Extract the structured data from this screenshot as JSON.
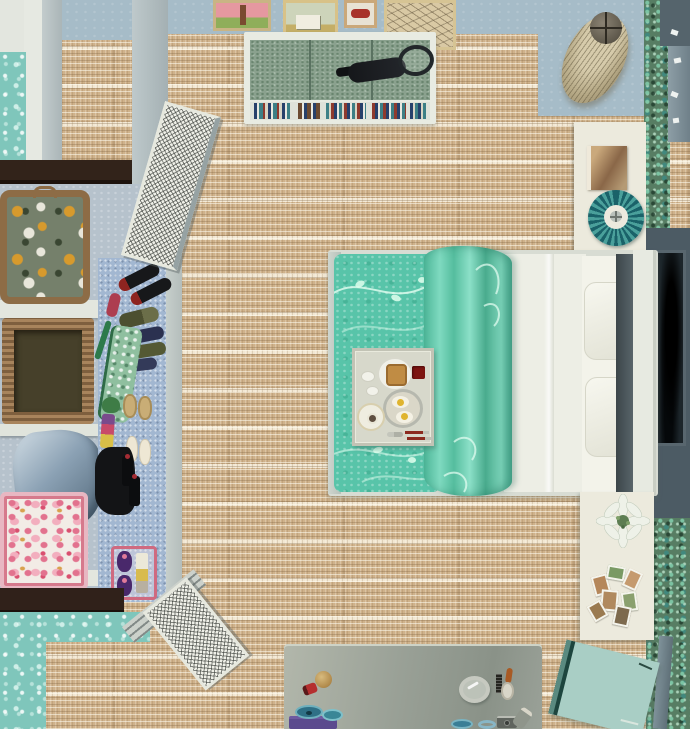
{
  "scene": {
    "view": "overhead dollhouse view",
    "room": "teal bedroom with open closet, bed with breakfast tray, bookcase and vanity desk"
  },
  "palette": {
    "floor_base": "#cfb28b",
    "floor_light": "#f0e6d0",
    "floor_dark": "#a5896a",
    "wall_blue": "#a6bcc8",
    "wall_teal_damask": "#7fc6bb",
    "wall_teal_mottled": "#577d63",
    "wall_dark_slate": "#4c5b64",
    "beam_brown": "#32231a",
    "bed_teal": "#58c4a9",
    "blanket_teal_light": "#7fdac0",
    "linen_white": "#edeee5",
    "bookcase_green": "#8aa18e",
    "desk_gray": "#99a096",
    "mat_blue": "#a2b7d1",
    "floor_book_seafoam": "#a9cec5",
    "cocoon_lamp_beige": "#c5b795",
    "pleated_lamp_teal": "#1a6269",
    "hamper_pink": "#e2728e",
    "suitcase_yellow": "#d79a2d"
  },
  "objects": {
    "floor": {
      "label": "woven sisal floor"
    },
    "wall_blue": {
      "label": "blue plaster wall"
    },
    "wall_damask": {
      "label": "teal damask wallpaper wall"
    },
    "wall_mottled": {
      "label": "teal patterned wallpaper wall"
    },
    "wall_dark": {
      "label": "dark slate wall panel"
    },
    "beam": {
      "label": "dark wood wall beam"
    },
    "art_pink": {
      "label": "framed painting - pink landscape with tree"
    },
    "art_house": {
      "label": "framed painting - country house"
    },
    "art_car": {
      "label": "framed print - red car"
    },
    "art_sketch": {
      "label": "framed botanical sketch"
    },
    "bookcase": {
      "label": "low bookcase with books"
    },
    "books": {
      "label": "row of book spines"
    },
    "racket": {
      "label": "tennis racket on bookcase"
    },
    "floor_lamp": {
      "label": "beige cocoon floor lamp"
    },
    "wall_hooks": {
      "label": "small wall hooks"
    },
    "nightstand_upper": {
      "label": "white nightstand (upper)"
    },
    "magazine": {
      "label": "magazine on nightstand"
    },
    "table_lamp": {
      "label": "teal pleated table lamp"
    },
    "bed": {
      "label": "double bed"
    },
    "comforter": {
      "label": "teal floral comforter"
    },
    "folded_blanket": {
      "label": "folded-back teal blanket"
    },
    "sheet": {
      "label": "white flat sheet"
    },
    "pillow": {
      "label": "white pillow"
    },
    "headboard": {
      "label": "white headboard"
    },
    "tray": {
      "label": "breakfast-in-bed tray"
    },
    "toast_plate": {
      "label": "plate with toast"
    },
    "jam": {
      "label": "jam dish"
    },
    "egg_platter": {
      "label": "silver platter with fried eggs"
    },
    "teacup": {
      "label": "teacup on saucer"
    },
    "cutlery": {
      "label": "cutlery"
    },
    "nightstand_lower": {
      "label": "white nightstand (lower)"
    },
    "lily": {
      "label": "white lily bouquet"
    },
    "photos": {
      "label": "scattered photographs"
    },
    "dark_art": {
      "label": "dark framed artwork"
    },
    "floor_book": {
      "label": "seafoam book on floor"
    },
    "desk": {
      "label": "gray vanity desk"
    },
    "lipstick": {
      "label": "red lipstick"
    },
    "compact": {
      "label": "gold compact"
    },
    "hand_mirror": {
      "label": "silver hand mirror"
    },
    "comb": {
      "label": "black comb"
    },
    "hairbrush": {
      "label": "hairbrush"
    },
    "trinket_bowls": {
      "label": "small blue bowls"
    },
    "basket_purple": {
      "label": "purple storage basket"
    },
    "camera": {
      "label": "small camera"
    },
    "perfume": {
      "label": "perfume bottle"
    },
    "shelf_unit": {
      "label": "white closet shelf unit"
    },
    "suitcase": {
      "label": "floral fabric suitcase"
    },
    "wicker_basket": {
      "label": "wicker storage basket"
    },
    "clothes_pile": {
      "label": "folded blue clothes"
    },
    "hamper": {
      "label": "pink floral hamper"
    },
    "shoe_mat": {
      "label": "blue shoe mat"
    },
    "heels_black": {
      "label": "black high heels"
    },
    "flats_olive": {
      "label": "olive flats"
    },
    "flats_navy": {
      "label": "navy flats"
    },
    "garment_bag": {
      "label": "green patterned garment bag"
    },
    "slippers_tan": {
      "label": "tan slippers"
    },
    "heels_white": {
      "label": "white heels"
    },
    "boots_black": {
      "label": "black boots"
    },
    "hat_green": {
      "label": "green hat"
    },
    "shoe_rack": {
      "label": "pink shoe rack with purple pumps"
    },
    "lattice_door": {
      "label": "white lattice closet door"
    }
  }
}
